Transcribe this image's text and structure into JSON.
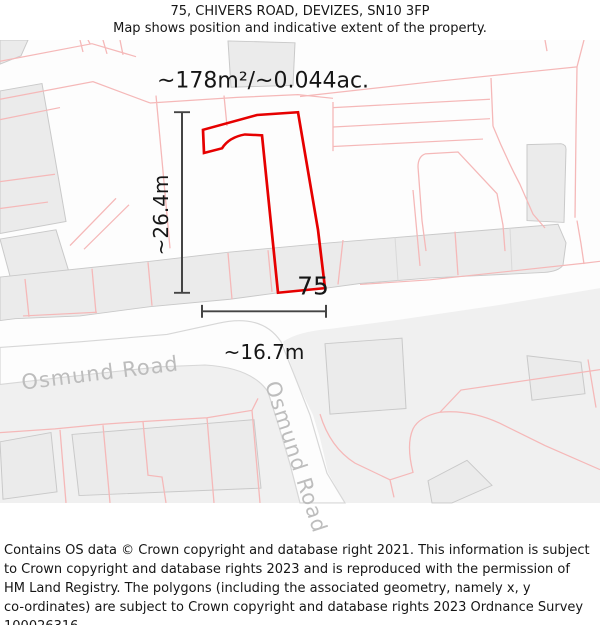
{
  "header": {
    "title": "75, CHIVERS ROAD, DEVIZES, SN10 3FP",
    "subtitle": "Map shows position and indicative extent of the property."
  },
  "map": {
    "area_label": "~178m²/~0.044ac.",
    "height_label": "~26.4m",
    "width_label": "~16.7m",
    "property_number": "75",
    "road_label_1": "Osmund Road",
    "road_label_2": "Osmund Road",
    "colors": {
      "property_outline": "#e60000",
      "parcel_line": "#f5b8b8",
      "building_fill": "#ebebeb",
      "building_stroke": "#c9c9c9",
      "road_casing": "#d7d7d7",
      "background_tint": "#f0f0f0",
      "road_label": "#bdbdbd",
      "measure_line": "#444444"
    }
  },
  "footer": {
    "lines": [
      "Contains OS data © Crown copyright and database right 2021. This information is subject",
      "to Crown copyright and database rights 2023 and is reproduced with the permission of",
      "HM Land Registry. The polygons (including the associated geometry, namely x, y",
      "co-ordinates) are subject to Crown copyright and database rights 2023 Ordnance Survey",
      "100026316."
    ]
  }
}
